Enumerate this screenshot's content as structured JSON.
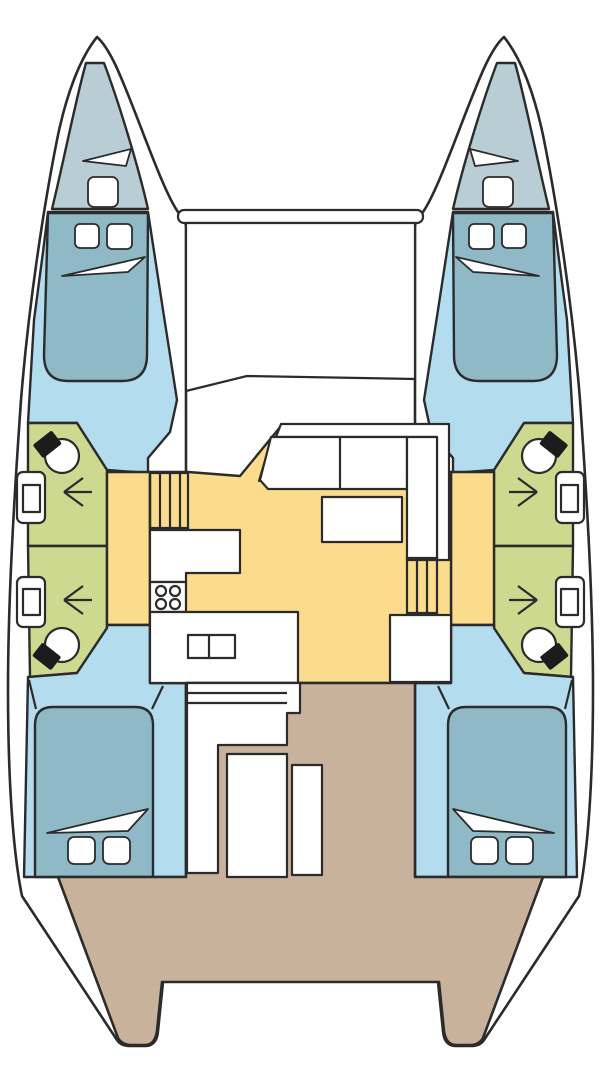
{
  "title": "Catamaran yacht layout floor plan (top view)",
  "colors": {
    "outline": "#2b2b2b",
    "hull_white": "#ffffff",
    "forepeak": "#b9cdd4",
    "bed": "#8fb9c6",
    "cabin_floor": "#b3ddef",
    "bathroom": "#ccd98f",
    "saloon": "#fbdb8c",
    "cockpit": "#c8b29b",
    "fixture_black": "#1c1c1c"
  },
  "regions": {
    "forepeak": "forepeak berth",
    "forward_cabin": "forward double cabin",
    "bathroom": "head / shower compartment",
    "corridor": "hull companionway corridor",
    "saloon": "saloon and galley",
    "aft_cabin": "aft double cabin",
    "cockpit": "aft cockpit deck",
    "trampoline": "bow trampoline"
  },
  "fixtures": {
    "toilets": 4,
    "sinks": 4,
    "stove_burners": 4,
    "cabins": 4,
    "forepeaks": 2,
    "saloon_table": 1,
    "cockpit_table": 1
  }
}
